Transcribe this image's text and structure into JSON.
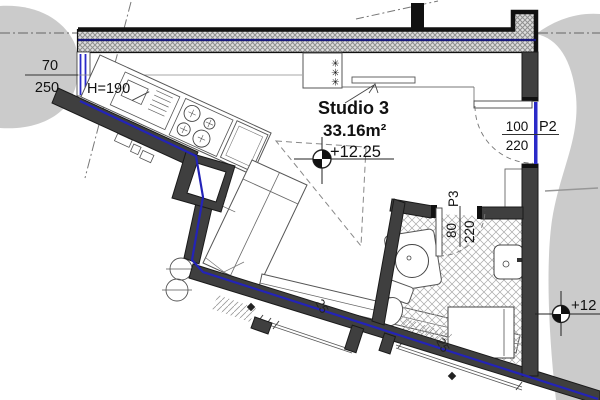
{
  "drawing": {
    "title": "floor plan",
    "room": {
      "name": "Studio 3",
      "area": "33.16m²",
      "level": "+12.25"
    },
    "window_w1": {
      "width": "70",
      "height": "250",
      "parapet": "H=190"
    },
    "door_p2": {
      "label": "P2",
      "width": "100",
      "height": "220"
    },
    "door_p3": {
      "label": "P3",
      "width": "80",
      "height": "220"
    },
    "wall_thickness": [
      "25",
      "25"
    ],
    "level_marker_right": "+12",
    "wardrobe_symbol": "✳✳✳",
    "colors": {
      "wall_fill": "#3f3f3f",
      "line_blue": "#2323b8",
      "wall_blue": "#17177d",
      "outside_gray": "#cbcbcb",
      "hatch_gray": "#8f8f8f"
    }
  }
}
